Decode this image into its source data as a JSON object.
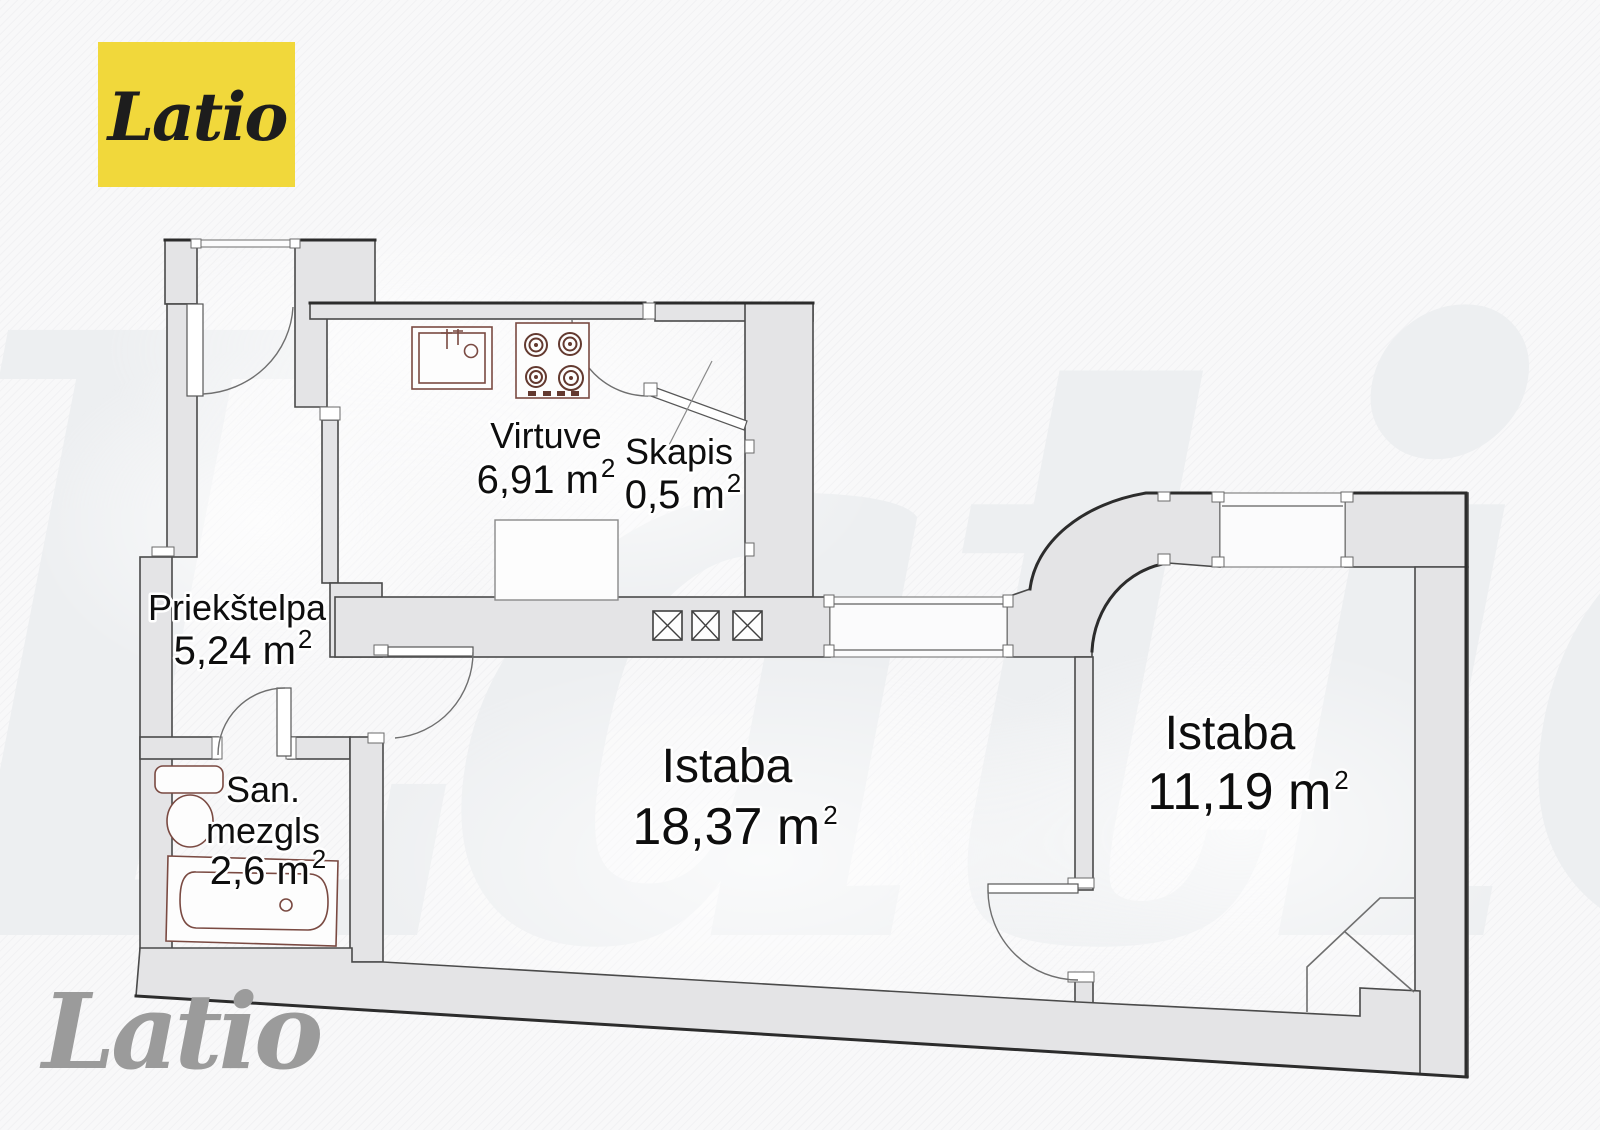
{
  "brand": {
    "logo_text": "Latio",
    "watermark_text": "Latio",
    "footer_watermark_text": "Latio"
  },
  "colors": {
    "logo_bg": "#f1d83b",
    "logo_fg": "#1d1d1d",
    "watermark": "#edeff1",
    "footer_watermark": "#9b9b9b",
    "wall_fill": "#e4e4e6",
    "fixture_stroke": "#7a4a42",
    "background": "#f8f8f9"
  },
  "rooms": [
    {
      "id": "virtuve",
      "name": "Virtuve",
      "area": "6,91 m",
      "sup": "2"
    },
    {
      "id": "skapis",
      "name": "Skapis",
      "area": "0,5 m",
      "sup": "2"
    },
    {
      "id": "priekstelpa",
      "name": "Priekštelpa",
      "area": "5,24 m",
      "sup": "2"
    },
    {
      "id": "san-mezgls",
      "name_line1": "San.",
      "name_line2": "mezgls",
      "area": "2,6 m",
      "sup": "2"
    },
    {
      "id": "istaba-1",
      "name": "Istaba",
      "area": "18,37 m",
      "sup": "2"
    },
    {
      "id": "istaba-2",
      "name": "Istaba",
      "area": "11,19 m",
      "sup": "2"
    }
  ]
}
